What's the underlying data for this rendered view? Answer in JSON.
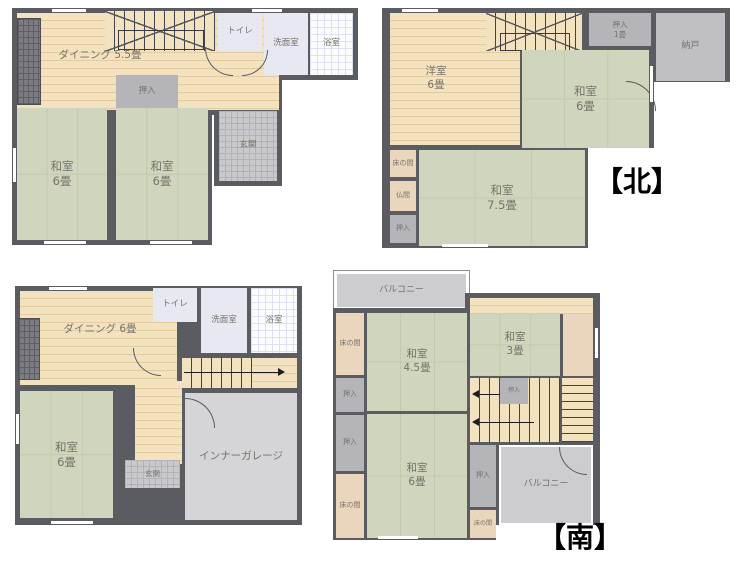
{
  "colors": {
    "wall": "#5b5b62",
    "wood_floor": "#f3e2c0",
    "tatami_green": "#cfd6bd",
    "closet_gray": "#b4b4b9",
    "garage_gray": "#d5d5d8",
    "balcony_gray": "#cdcdd1",
    "sanitary_lavender": "#e8e8f2",
    "tokonoma_tan": "#ead6bd",
    "label_text": "#76716b",
    "direction_text": "#000000"
  },
  "direction_labels": {
    "north": "【北】",
    "south": "【南】"
  },
  "plans": [
    {
      "rooms": {
        "dining": {
          "name": "ダイニング",
          "size": "5.5畳"
        },
        "oshiire": {
          "name": "押入"
        },
        "toilet": {
          "name": "トイレ"
        },
        "washroom": {
          "name": "洗面室"
        },
        "bath": {
          "name": "浴室"
        },
        "washitsu_left": {
          "name": "和室",
          "size": "6畳"
        },
        "washitsu_right": {
          "name": "和室",
          "size": "6畳"
        },
        "genkan": {
          "name": "玄関"
        }
      }
    },
    {
      "rooms": {
        "youshitsu": {
          "name": "洋室",
          "size": "6畳"
        },
        "oshiire_1jo": {
          "name": "押入",
          "size": "1畳"
        },
        "nando": {
          "name": "納戸"
        },
        "washitsu_6": {
          "name": "和室",
          "size": "6畳"
        },
        "washitsu_75": {
          "name": "和室",
          "size": "7.5畳"
        },
        "tokonoma": {
          "name": "床の間"
        },
        "butsuma": {
          "name": "仏間"
        },
        "oshiire": {
          "name": "押入"
        }
      }
    },
    {
      "rooms": {
        "dining": {
          "name": "ダイニング",
          "size": "6畳"
        },
        "toilet": {
          "name": "トイレ"
        },
        "washroom": {
          "name": "洗面室"
        },
        "bath": {
          "name": "浴室"
        },
        "washitsu": {
          "name": "和室",
          "size": "6畳"
        },
        "genkan": {
          "name": "玄関"
        },
        "garage": {
          "name": "インナーガレージ"
        }
      }
    },
    {
      "rooms": {
        "balcony_top": {
          "name": "バルコニー"
        },
        "tokonoma_top": {
          "name": "床の間"
        },
        "oshiire_a": {
          "name": "押入"
        },
        "oshiire_b": {
          "name": "押入"
        },
        "tokonoma_bottom": {
          "name": "床の間"
        },
        "washitsu_45": {
          "name": "和室",
          "size": "4.5畳"
        },
        "washitsu_3": {
          "name": "和室",
          "size": "3畳"
        },
        "oshiire_stairs": {
          "name": "押入"
        },
        "oshiire_c": {
          "name": "押入"
        },
        "tokonoma_small": {
          "name": "床の間"
        },
        "balcony_right": {
          "name": "バルコニー"
        },
        "washitsu_6": {
          "name": "和室",
          "size": "6畳"
        }
      }
    }
  ]
}
